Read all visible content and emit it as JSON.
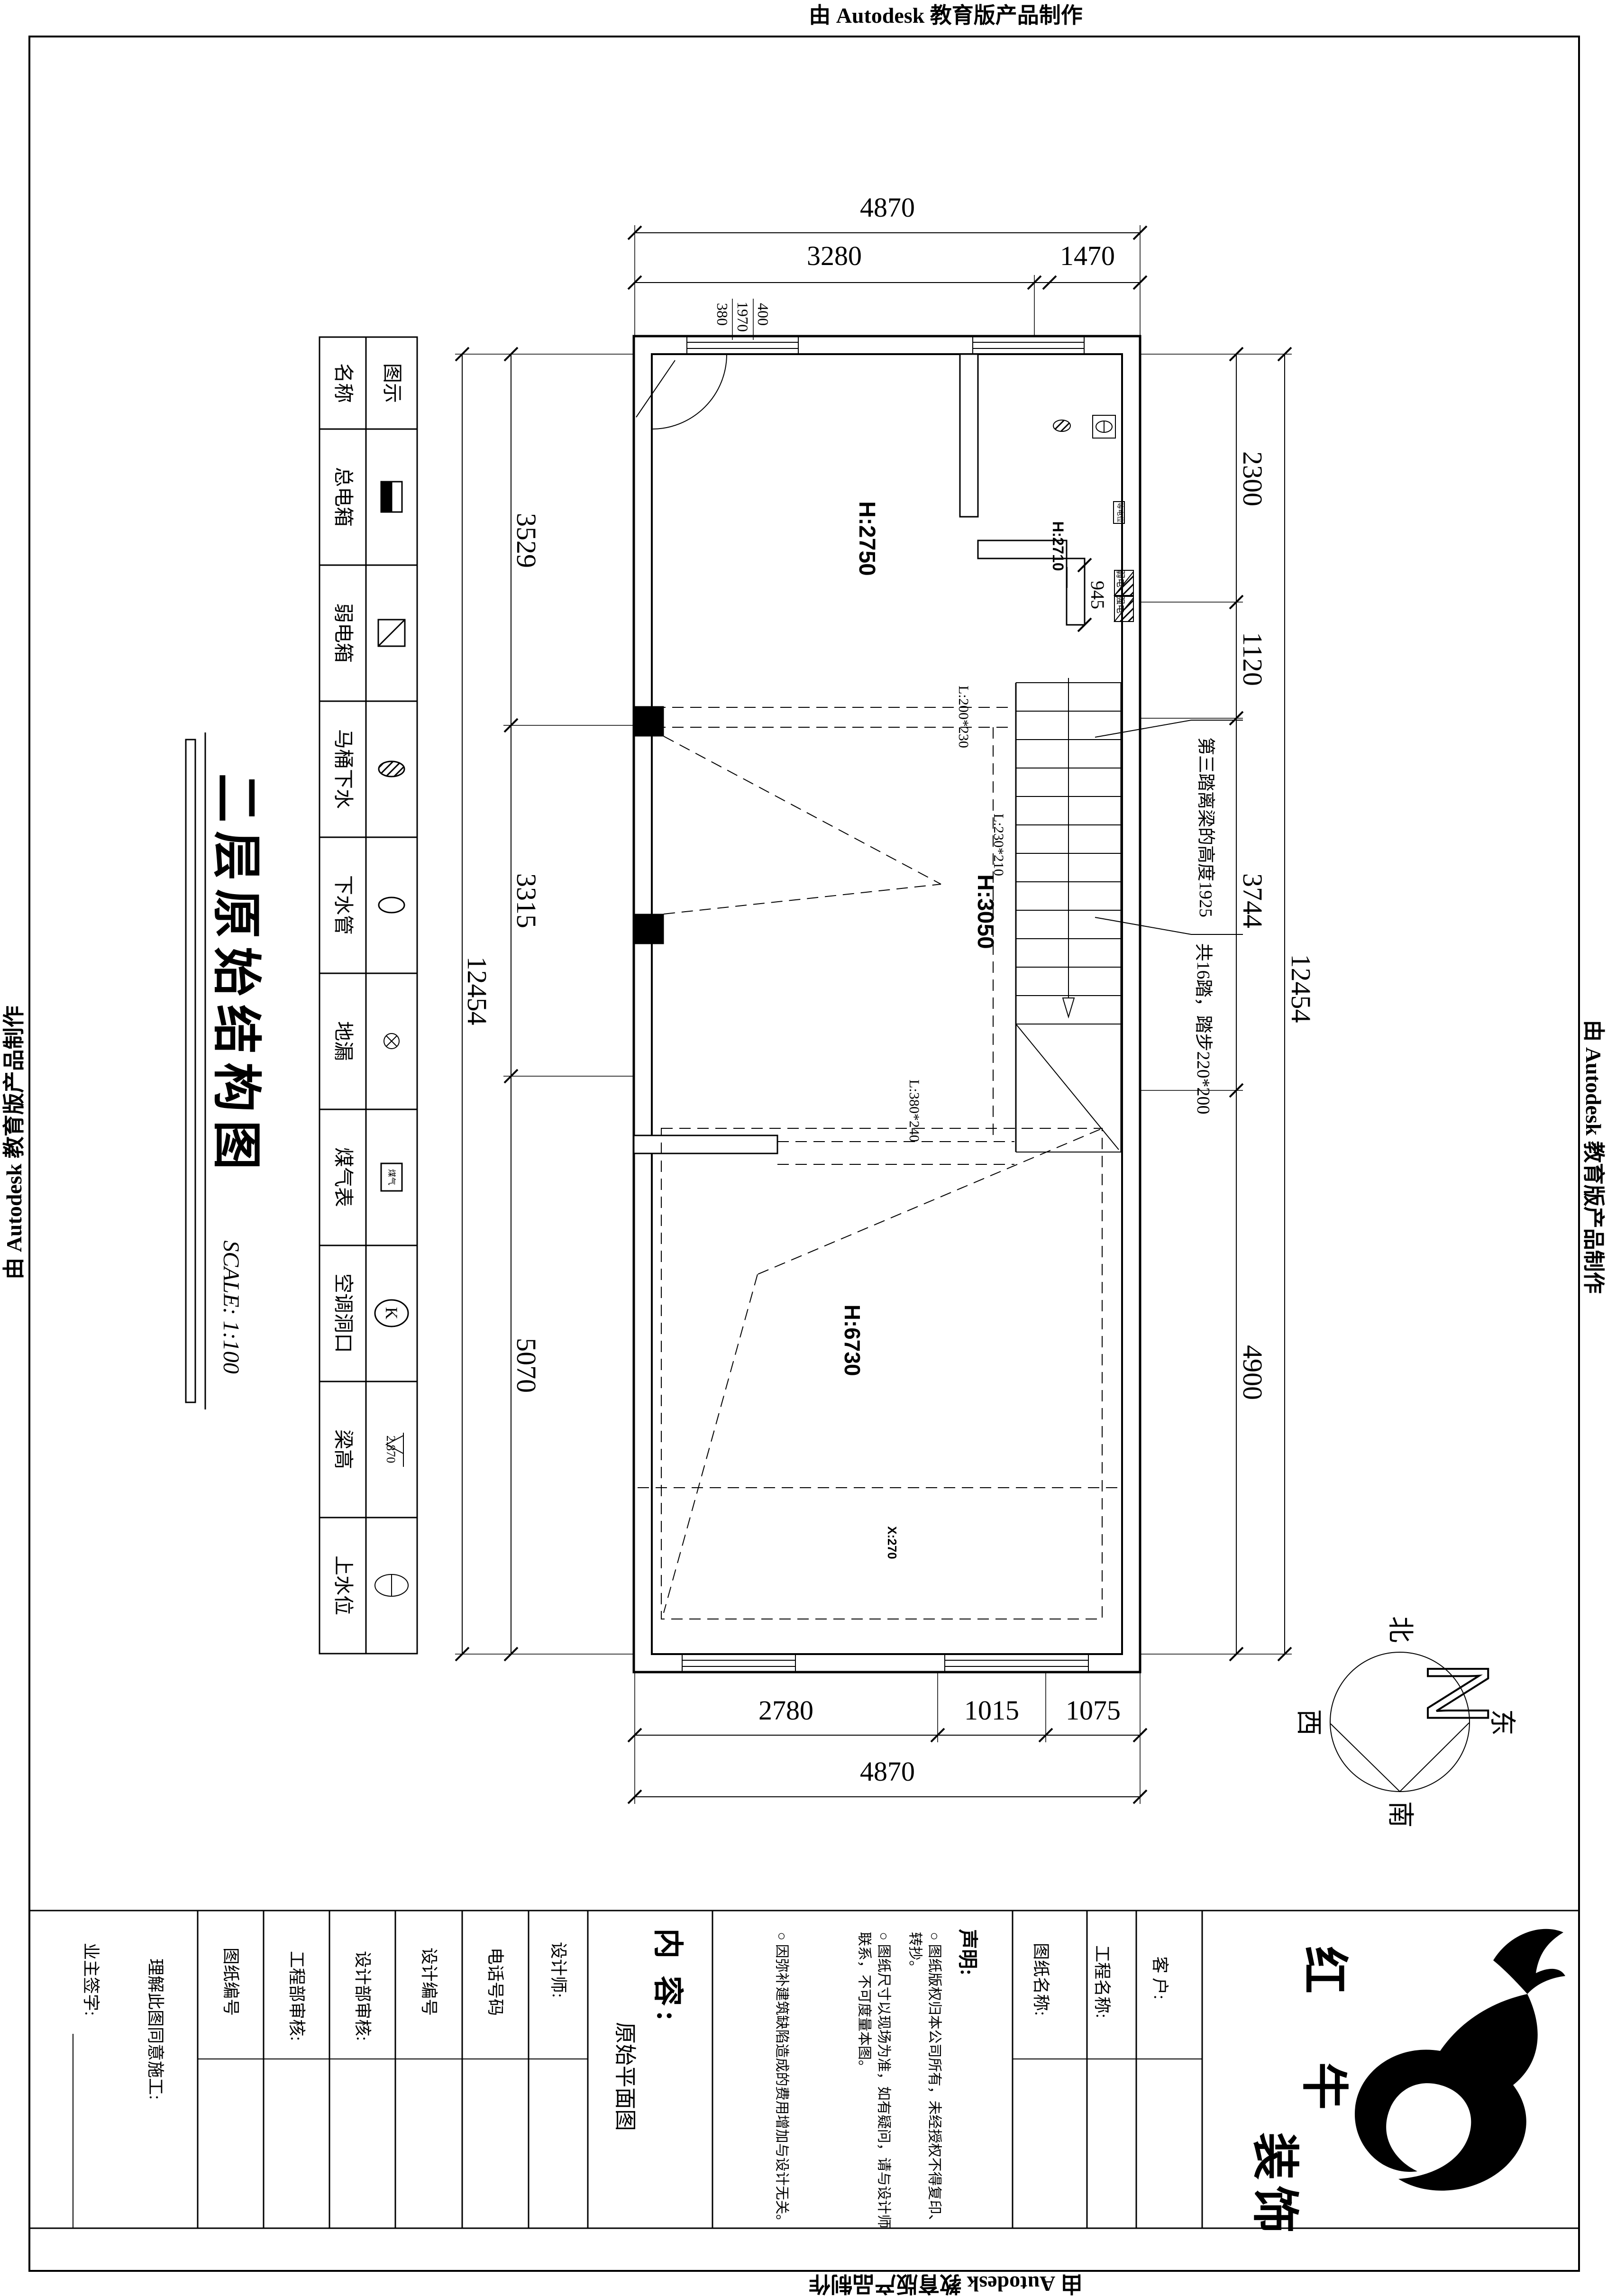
{
  "watermark": "由 Autodesk 教育版产品制作",
  "drawing_title": "二层原始结构图",
  "drawing_scale": "SCALE: 1:100",
  "legend": {
    "header": {
      "name": "名称",
      "icon": "图示"
    },
    "rows": [
      {
        "name": "总电箱",
        "icon": "main-electric-box"
      },
      {
        "name": "弱电箱",
        "icon": "weak-electric-box"
      },
      {
        "name": "马桶下水",
        "icon": "toilet-drain"
      },
      {
        "name": "下水管",
        "icon": "drain-pipe"
      },
      {
        "name": "地漏",
        "icon": "floor-drain"
      },
      {
        "name": "煤气表",
        "icon": "gas-meter",
        "icon_text": "煤气"
      },
      {
        "name": "空调洞口",
        "icon": "ac-hole",
        "icon_text": "K"
      },
      {
        "name": "梁高",
        "icon": "beam-height",
        "icon_text": "2.870"
      },
      {
        "name": "上水位",
        "icon": "water-supply"
      }
    ]
  },
  "plan": {
    "rooms": [
      {
        "label": "H:2750"
      },
      {
        "label": "H:2710"
      },
      {
        "label": "H:3050"
      },
      {
        "label": "H:6730"
      },
      {
        "label": "X:270"
      }
    ],
    "beams": [
      "L:200*230",
      "L:230*210",
      "L:380*240"
    ],
    "stair_notes": [
      "第三踏离梁的高度1925",
      "共16踏，踏步220*200"
    ],
    "electrical": {
      "equipotential": "等电位",
      "weak": "弱电",
      "strong": "强电"
    }
  },
  "dims": {
    "top": {
      "overall": "4870",
      "seg1": "3280",
      "seg2": "1470"
    },
    "top_sub": {
      "a": "400",
      "b": "1970",
      "c": "380"
    },
    "bottom": {
      "overall": "4870",
      "seg1": "2780",
      "seg2": "1015",
      "seg3": "1075"
    },
    "left": {
      "overall": "12454",
      "seg1": "3529",
      "seg2": "3315",
      "seg3": "5070"
    },
    "right": {
      "overall": "12454",
      "seg1": "2300",
      "seg2": "1120",
      "seg3": "3744",
      "seg4": "4900"
    },
    "passage": "945"
  },
  "compass": {
    "n": "N",
    "north": "北",
    "south": "南",
    "east": "东",
    "west": "西"
  },
  "titleblock": {
    "owner_sign": "业主签字:",
    "agree": "理解此图同意施工:",
    "drawing_no": "图纸编号",
    "eng_audit": "工程部审核:",
    "design_audit": "设计部审核:",
    "design_no": "设计编号",
    "phone": "电话号码",
    "designer": "设计师:",
    "content_label": "内 容:",
    "content_value": "原始平面图",
    "statement_title": "声明:",
    "statements": [
      "○ 图纸版权归本公司所有，未经授权不得复印、转抄。",
      "○ 图纸尺寸以现场为准，如有疑问，请与设计师联系，不可度量本图。",
      "○ 因弥补建筑缺陷造成的费用增加与设计无关。"
    ],
    "drawing_name": "图纸名称:",
    "project_name": "工程名称:",
    "client": "客 户:",
    "brand": {
      "c1": "红",
      "c2": "牛",
      "c3": "装",
      "c4": "饰"
    }
  }
}
